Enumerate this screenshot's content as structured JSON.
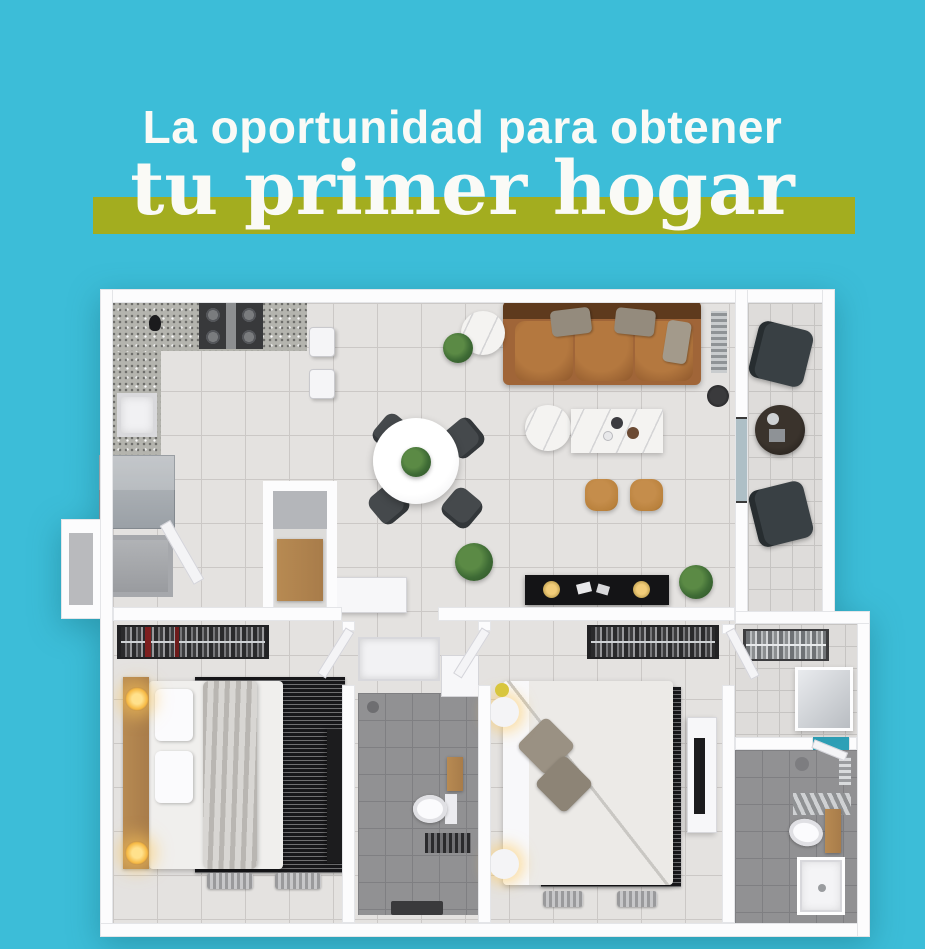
{
  "headline": {
    "line1": "La oportunidad para obtener",
    "line2": "tu primer hogar"
  },
  "colors": {
    "bg": "#3cbdd8",
    "highlight": "#a3ad1f",
    "headline": "#fafaf6",
    "wall": "#fcfcfd",
    "wall-edge": "#e4e5e8",
    "floor": "#e4e2e0",
    "floor-line": "#cbc8c6",
    "floor-gray": "#919193",
    "floor-gray-line": "#7f7f82",
    "granite": "#b4b4ae",
    "marble": "#f4f3f1",
    "sofa": "#a06538",
    "sofa-dark": "#5e3a1d",
    "pouf": "#b9813c",
    "wood": "#a87c4a",
    "rug": "#17171a",
    "chair-dark": "#45494c",
    "balcony-chair": "#394044",
    "fridge": "#9aa0a6",
    "stove": "#38393b",
    "plant": "#3e6b35",
    "glow": "#f6b944",
    "door": "#f4f4f6",
    "tv-black": "#141416"
  },
  "floorplan": {
    "type": "apartment-top-view-3d-render",
    "rooms": [
      "kitchen",
      "dining-area",
      "living-room",
      "balcony",
      "entry",
      "pantry-closet",
      "secondary-bedroom",
      "shared-bathroom",
      "master-bedroom",
      "walk-in-closet",
      "master-bathroom",
      "hallway"
    ],
    "furniture": [
      "stove",
      "kitchen-sink",
      "refrigerator",
      "kitchen-stools",
      "dining-table",
      "dining-chairs",
      "leather-sofa",
      "marble-coffee-table",
      "marble-side-table",
      "leather-poufs",
      "tv-console",
      "balcony-chairs",
      "balcony-table",
      "beds",
      "nightstand-lamps",
      "closet-clothes-racks",
      "toilets",
      "vanities",
      "showers",
      "rugs",
      "plants"
    ]
  }
}
